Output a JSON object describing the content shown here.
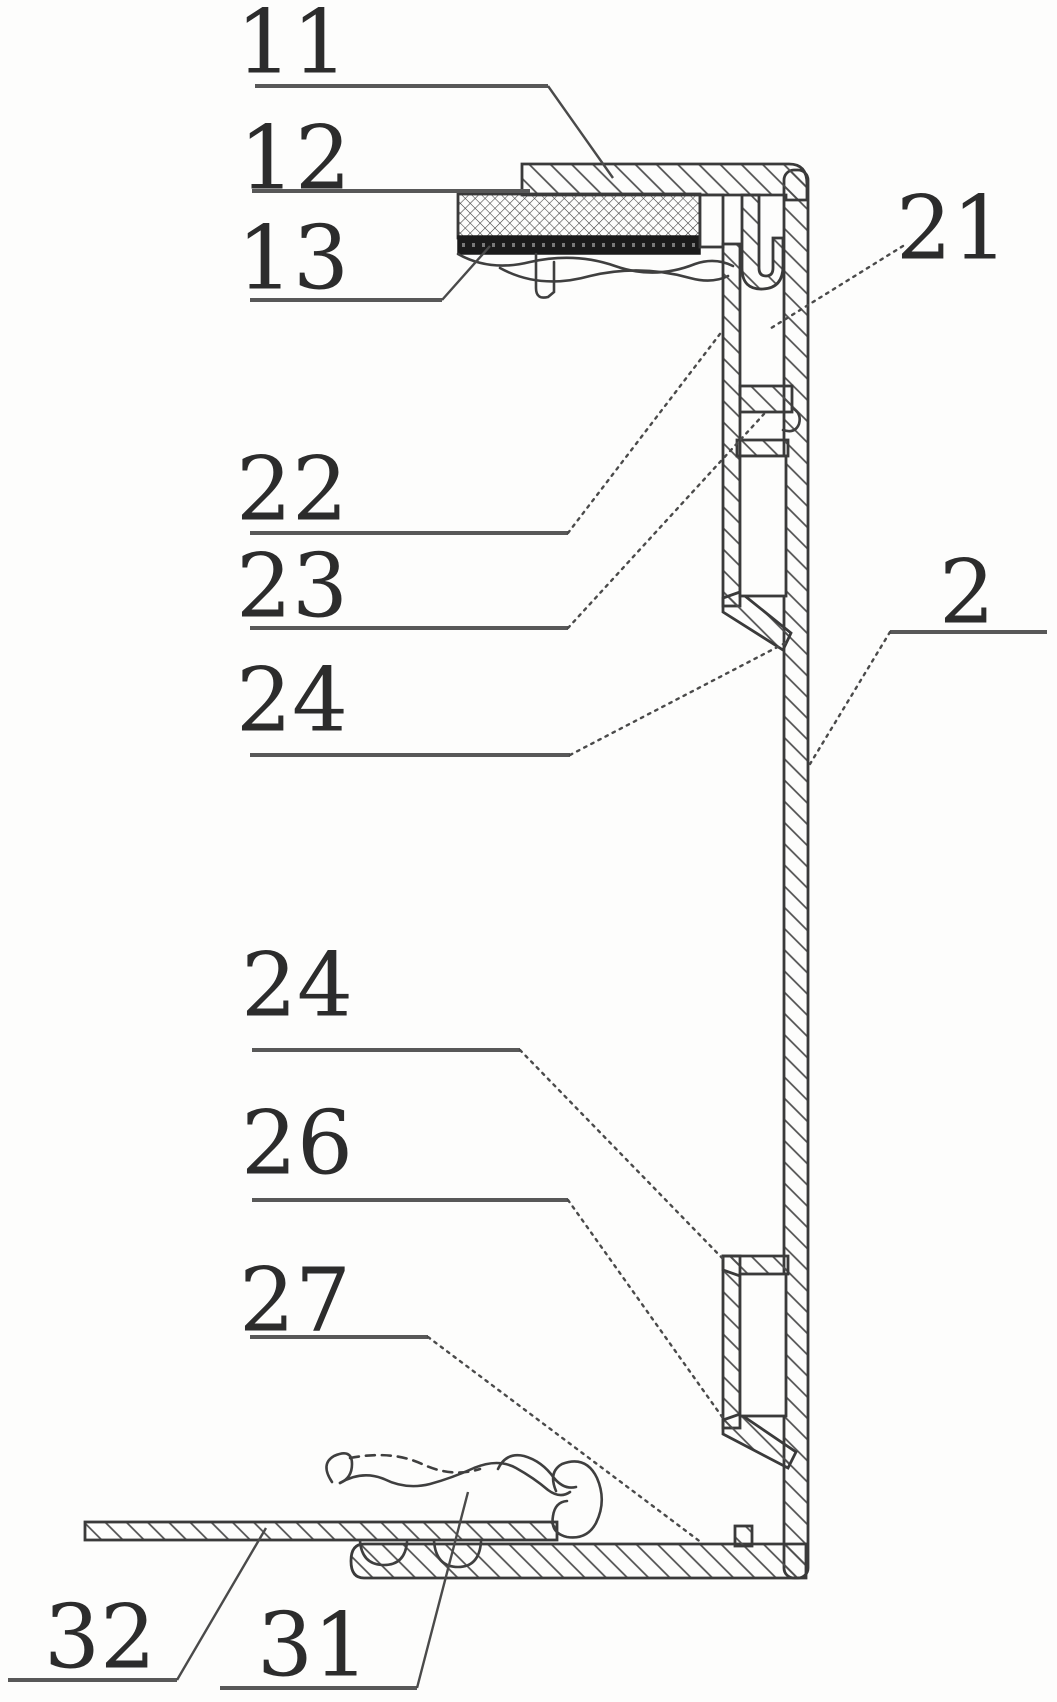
{
  "figure": {
    "kind": "patent cross-section drawing",
    "background_color": "#fdfdfc",
    "line_color": "#3a3a3a",
    "label_color": "#2c2c2c",
    "labels": {
      "n11": {
        "text": "11"
      },
      "n12": {
        "text": "12"
      },
      "n13": {
        "text": "13"
      },
      "n21": {
        "text": "21"
      },
      "n22": {
        "text": "22"
      },
      "n23": {
        "text": "23"
      },
      "n24a": {
        "text": "24"
      },
      "n24b": {
        "text": "24"
      },
      "n26": {
        "text": "26"
      },
      "n27": {
        "text": "27"
      },
      "n2": {
        "text": "2"
      },
      "n31": {
        "text": "31"
      },
      "n32": {
        "text": "32"
      }
    }
  }
}
